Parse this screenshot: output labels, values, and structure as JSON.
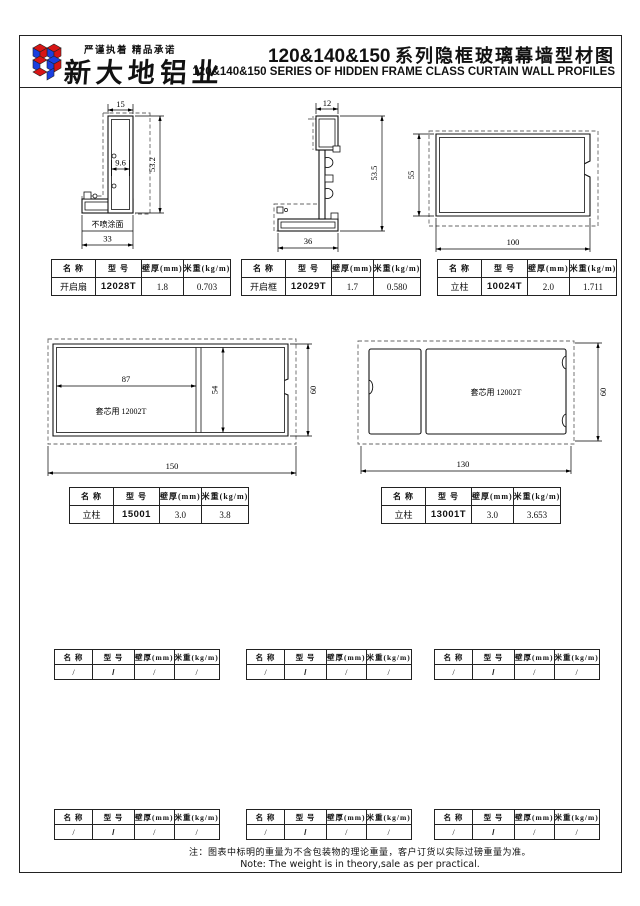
{
  "header": {
    "slogan": "严谨执着  精品承诺",
    "company": "新大地铝业",
    "title_num": "120&140&150",
    "title_cn": "系列隐框玻璃幕墙型材图",
    "title_en": "120&140&150   SERIES OF HIDDEN FRAME CLASS CURTAIN WALL PROFILES"
  },
  "table_headers": {
    "name": "名 称",
    "model": "型 号",
    "thickness": "壁厚(mm)",
    "weight": "米重(kg/m)"
  },
  "profiles": [
    {
      "name": "开启扇",
      "model": "12028T",
      "thickness": "1.8",
      "weight": "0.703"
    },
    {
      "name": "开启框",
      "model": "12029T",
      "thickness": "1.7",
      "weight": "0.580"
    },
    {
      "name": "立柱",
      "model": "10024T",
      "thickness": "2.0",
      "weight": "1.711"
    },
    {
      "name": "立柱",
      "model": "15001",
      "thickness": "3.0",
      "weight": "3.8"
    },
    {
      "name": "立柱",
      "model": "13001T",
      "thickness": "3.0",
      "weight": "3.653"
    }
  ],
  "drawings": {
    "d1": {
      "dim_top": "15",
      "dim_inner": "9.6",
      "dim_height": "53.2",
      "dim_bottom": "33",
      "surface_label": "不喷涂面"
    },
    "d2": {
      "dim_top": "12",
      "dim_height": "53.5",
      "dim_bottom": "36"
    },
    "d3": {
      "dim_height": "55",
      "dim_width": "100"
    },
    "d4": {
      "dim_inner_w": "87",
      "dim_inner_h": "54",
      "dim_height": "60",
      "dim_width": "150",
      "core_label": "套芯用 12002T"
    },
    "d5": {
      "dim_height": "60",
      "dim_width": "130",
      "core_label": "套芯用 12002T"
    }
  },
  "empty_value": "/",
  "note": {
    "cn": "注：图表中标明的重量为不含包装物的理论重量，客户订货以实际过磅重量为准。",
    "en": "Note: The weight is in theory,sale as per practical."
  }
}
